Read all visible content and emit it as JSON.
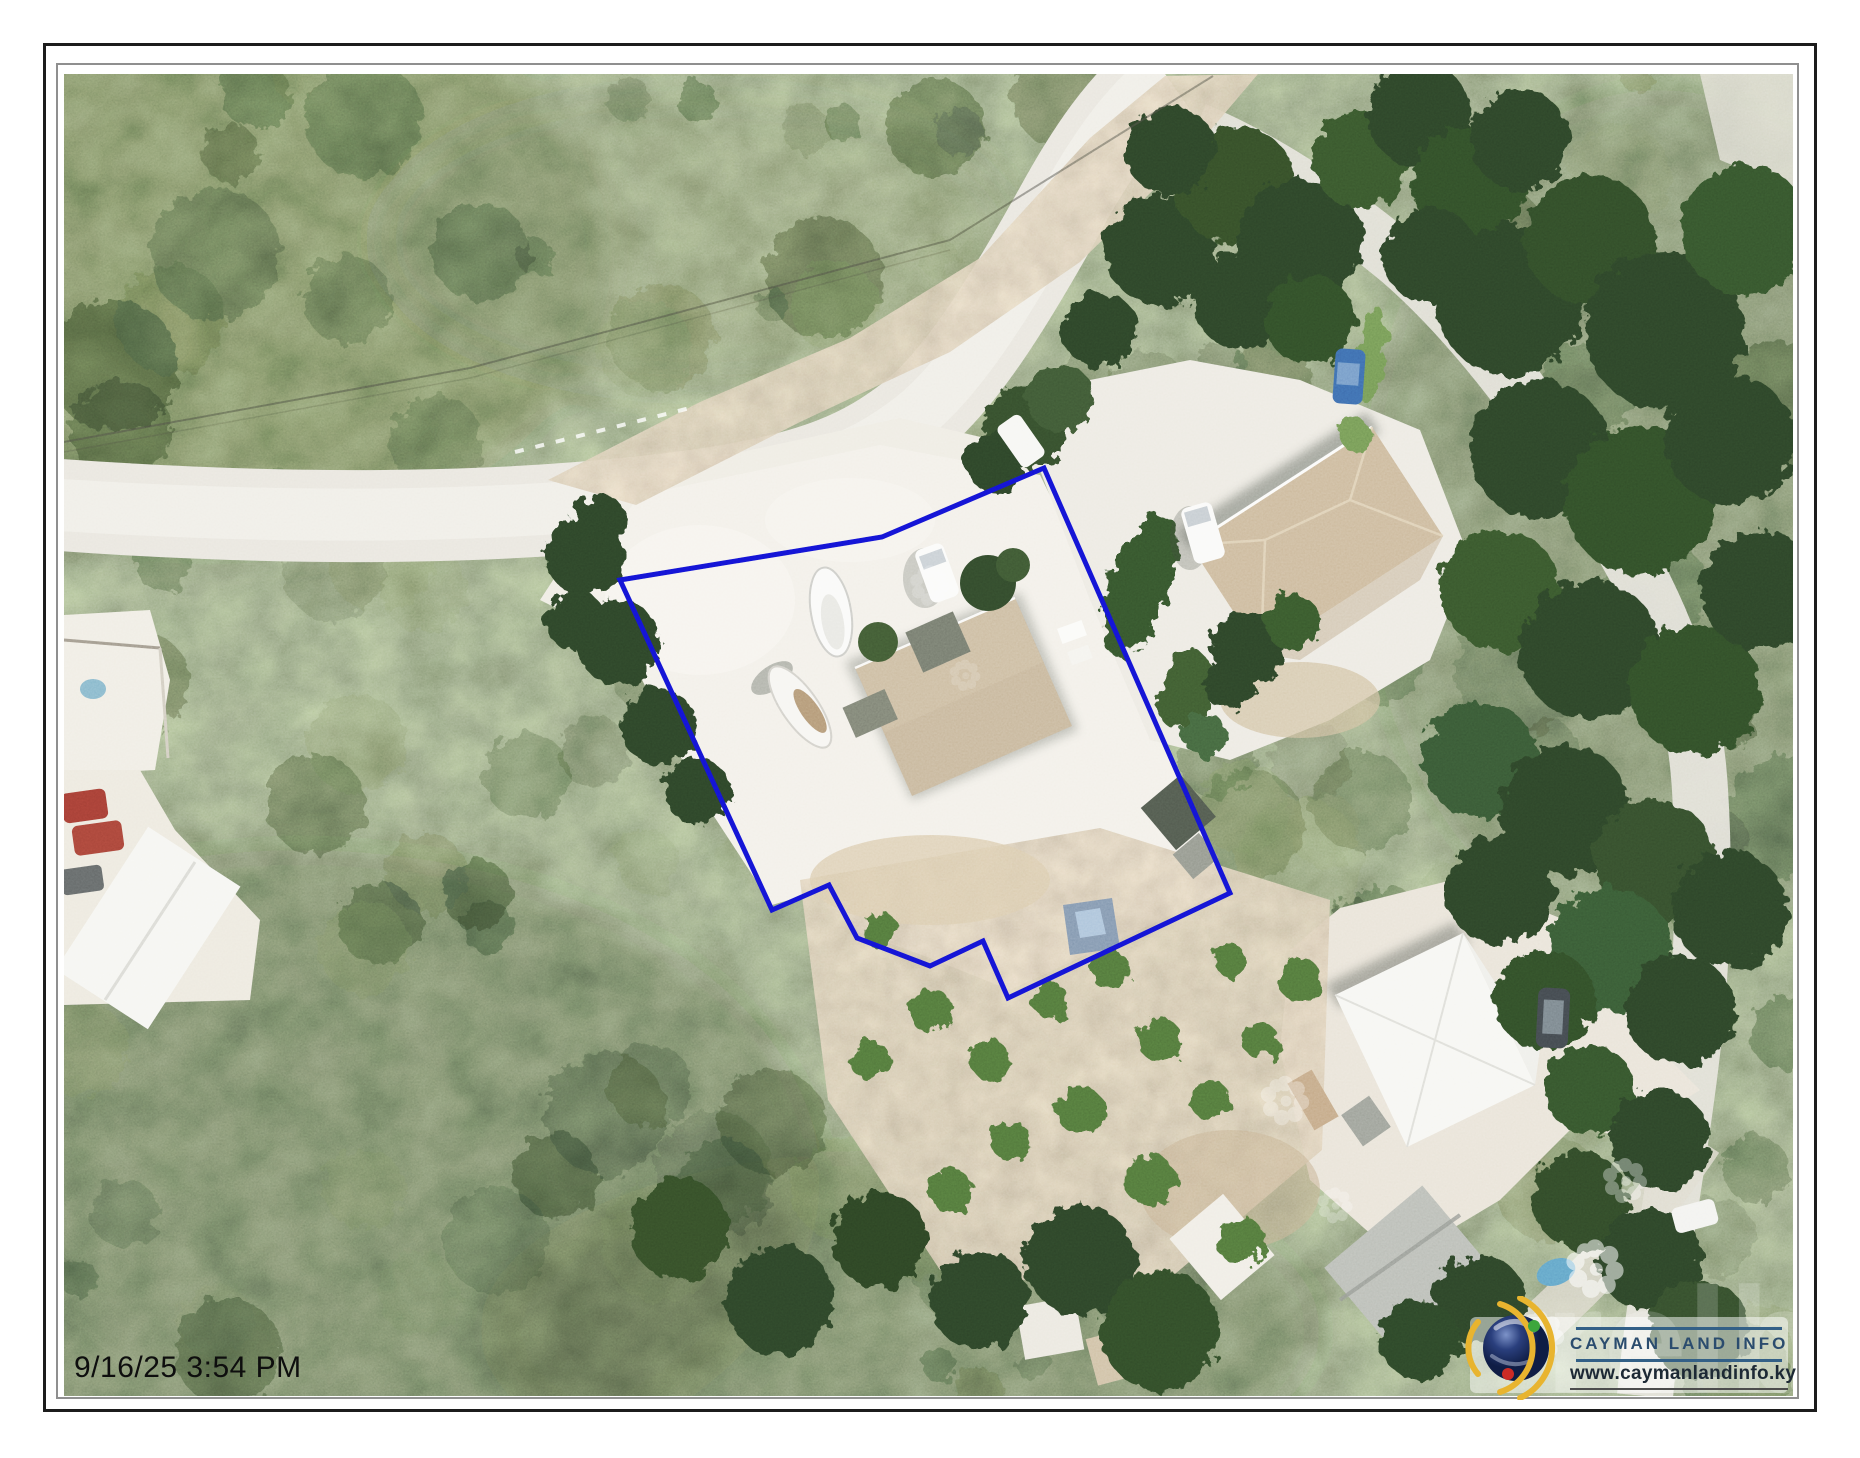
{
  "page": {
    "timestamp": "9/16/25 3:54 PM"
  },
  "map": {
    "type": "aerial-imagery-parcel-map",
    "parcel_outline_color": "#1212cf",
    "parcel_points": "620,580 882,537 1044,468 1230,893 1008,998 983,941 930,966 857,938 829,885 772,910"
  },
  "logo": {
    "icon": "globe-orbit-icon",
    "title": "CAYMAN LAND INFO",
    "website": "www.caymanlandinfo.ky",
    "title_color": "#2b4c6e",
    "rule_color": "#336087"
  },
  "watermark": {
    "text": "relb"
  }
}
